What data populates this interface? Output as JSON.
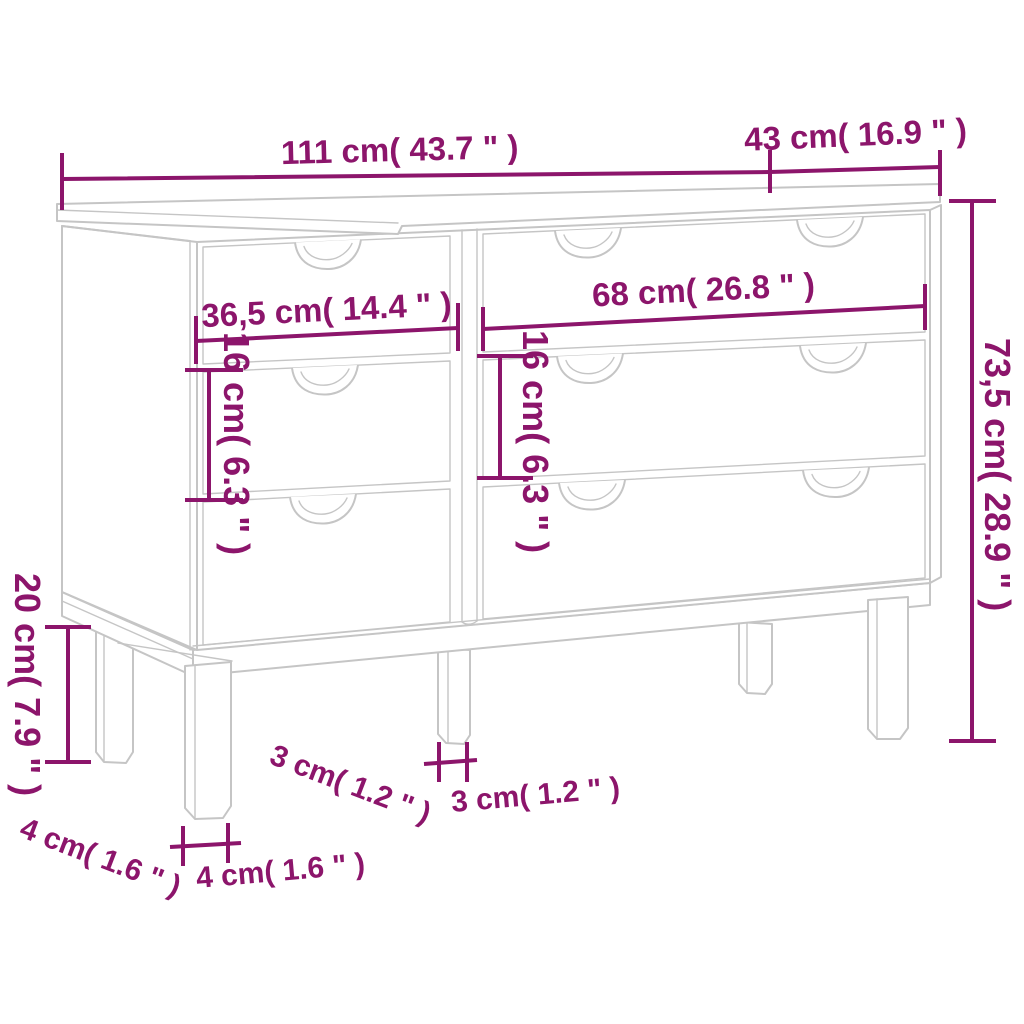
{
  "colors": {
    "dimension": "#8C156B",
    "furniture_line": "#C5C5C5",
    "background": "#FFFFFF"
  },
  "diagram": {
    "subject": "six-drawer dresser line drawing with measurement callouts",
    "labels": {
      "top_width": "111 cm( 43.7 \" )",
      "top_depth": "43 cm( 16.9 \" )",
      "left_drawer_width": "36,5 cm( 14.4 \" )",
      "right_drawer_width": "68 cm( 26.8 \" )",
      "left_drawer_height": "16 cm( 6.3 \" )",
      "right_drawer_height": "16 cm( 6.3 \" )",
      "total_height": "73,5 cm( 28.9 \" )",
      "leg_height": "20 cm( 7.9 \" )",
      "leg_depth_diagonal": "3 cm( 1.2 \" )",
      "leg_depth_horizontal": "3 cm( 1.2 \" )",
      "leg_width_diagonal": "4 cm( 1.6 \" )",
      "leg_width_horizontal": "4 cm( 1.6 \" )"
    }
  }
}
